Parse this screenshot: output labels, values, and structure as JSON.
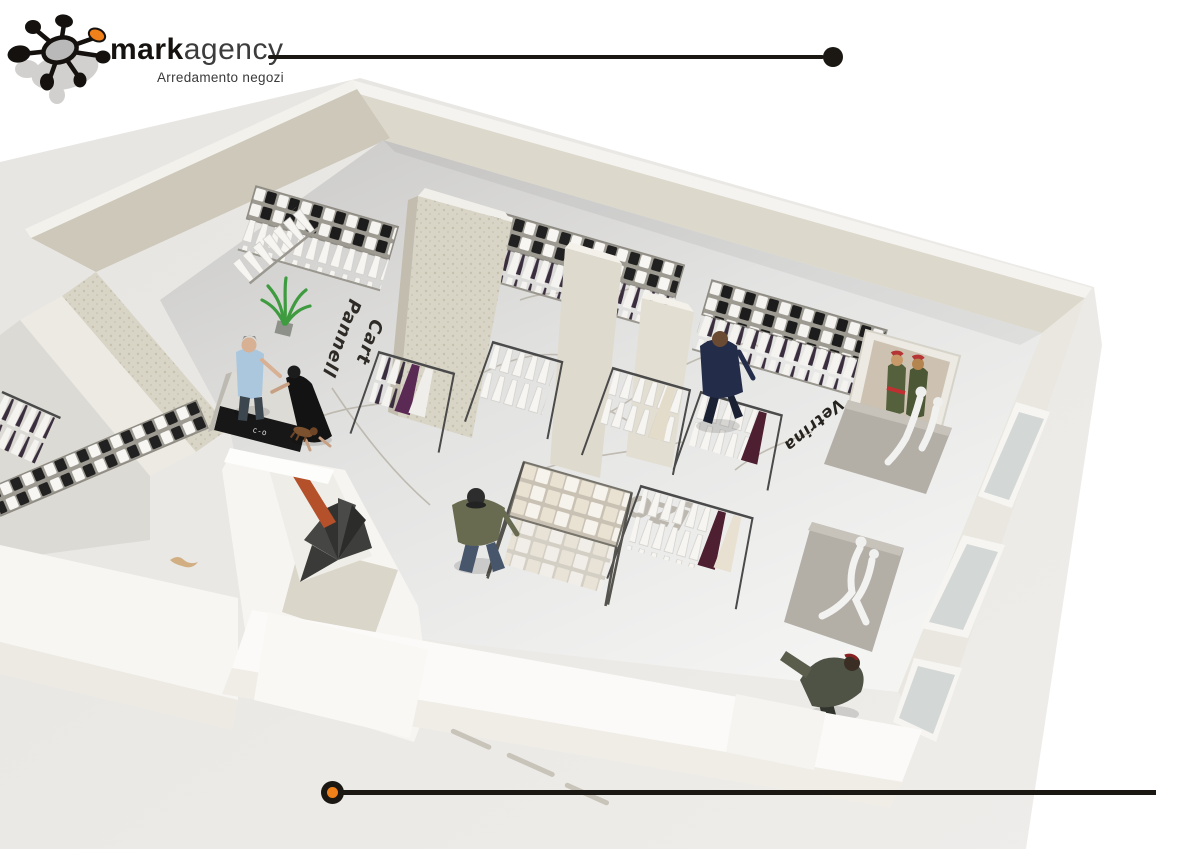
{
  "brand": {
    "name_bold": "mark",
    "name_light": "agency",
    "tagline": "Arredamento negozi"
  },
  "colors": {
    "ink": "#1b1713",
    "accent_orange": "#f08019",
    "paper_grey": "#ebe9e5",
    "wall_beige": "#d9d5c8",
    "floor_light": "#f2f2f1",
    "stair_rail_orange": "#b4512a"
  },
  "scene": {
    "description": "Bird's-eye 3D rendering of a clothing store interior over a sketch floor plan",
    "floor_annotations": [
      {
        "text": "Pannell"
      },
      {
        "text": "Cart"
      },
      {
        "text": "Vetrina"
      },
      {
        "text": "gozi"
      },
      {
        "text": "Vet"
      }
    ],
    "cash_desk_logo": "c-o"
  }
}
